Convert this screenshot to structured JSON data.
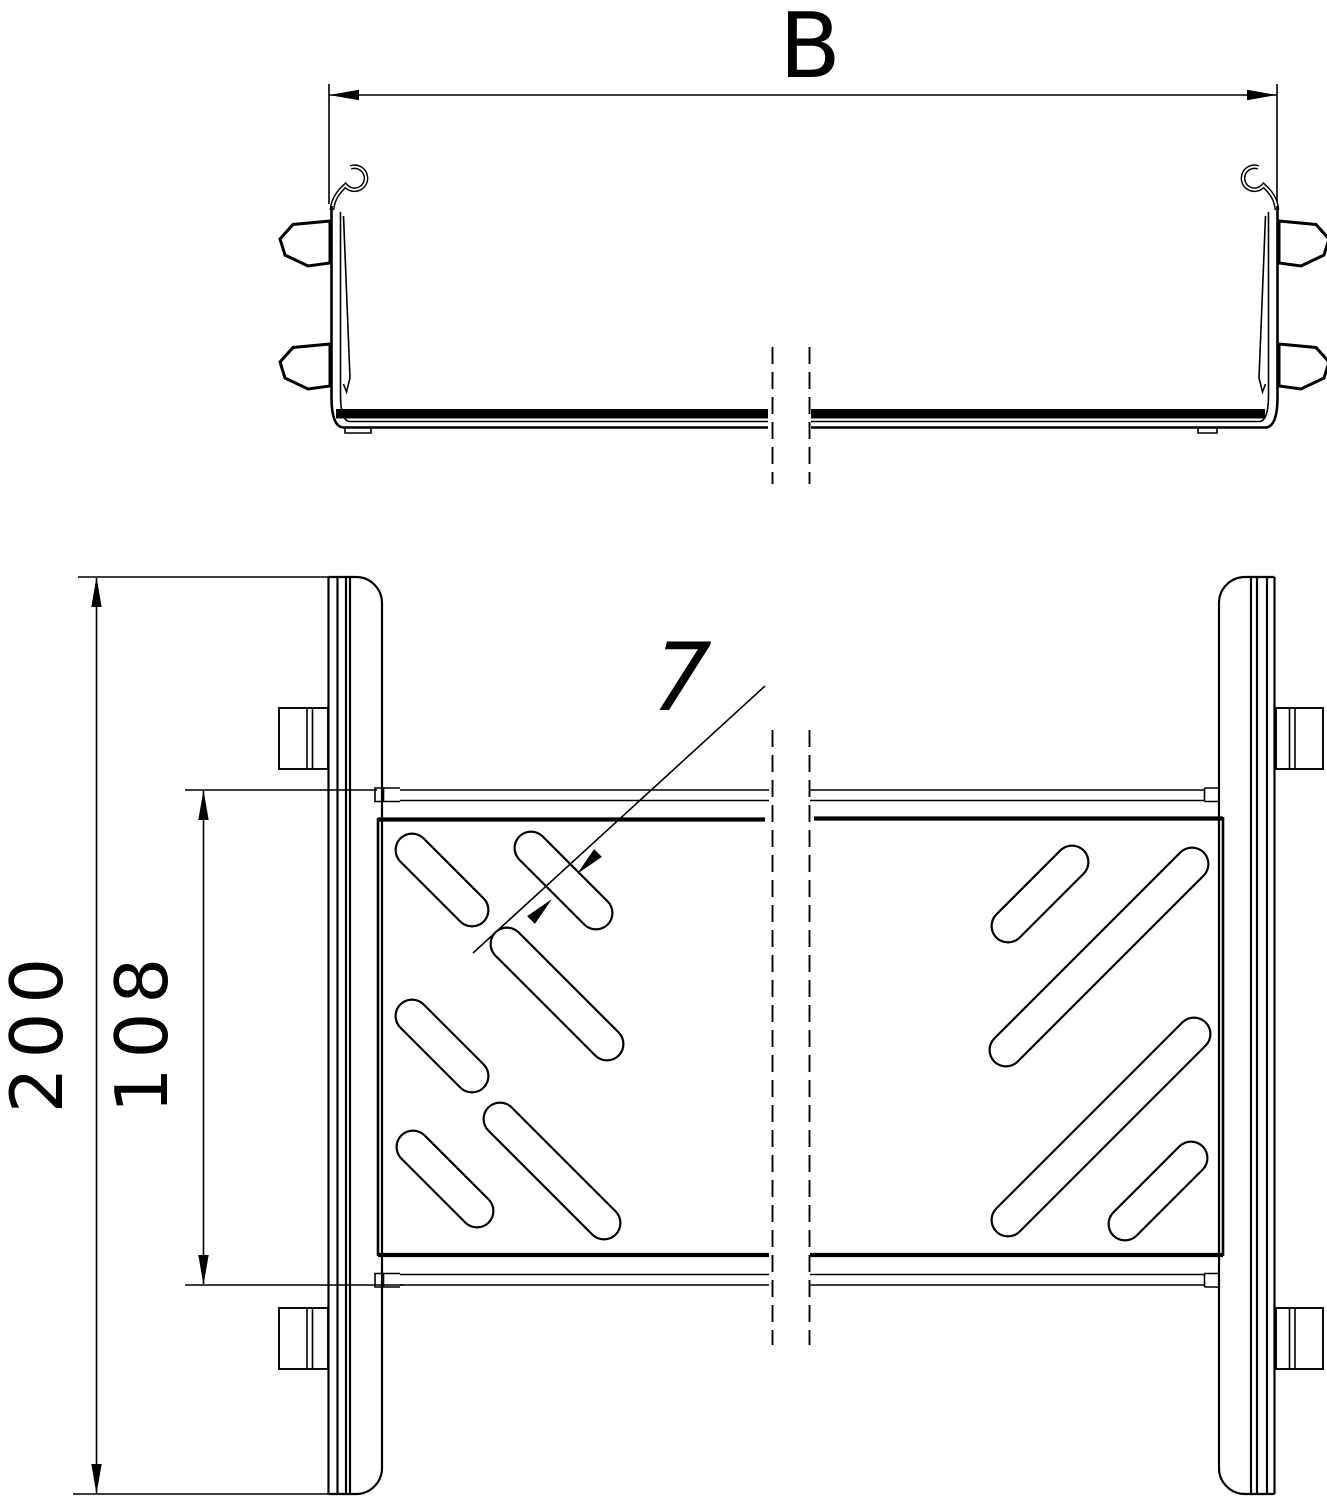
{
  "drawing": {
    "background": "#ffffff",
    "line_color": "#000000",
    "cross_section_view": {
      "width_dimension_label": "B"
    },
    "plan_view": {
      "overall_width_dimension": "200",
      "inner_width_dimension": "108",
      "slot_width_dimension": "7",
      "values": {
        "overall": 200,
        "inner": 108,
        "slot_width": 7
      }
    }
  }
}
